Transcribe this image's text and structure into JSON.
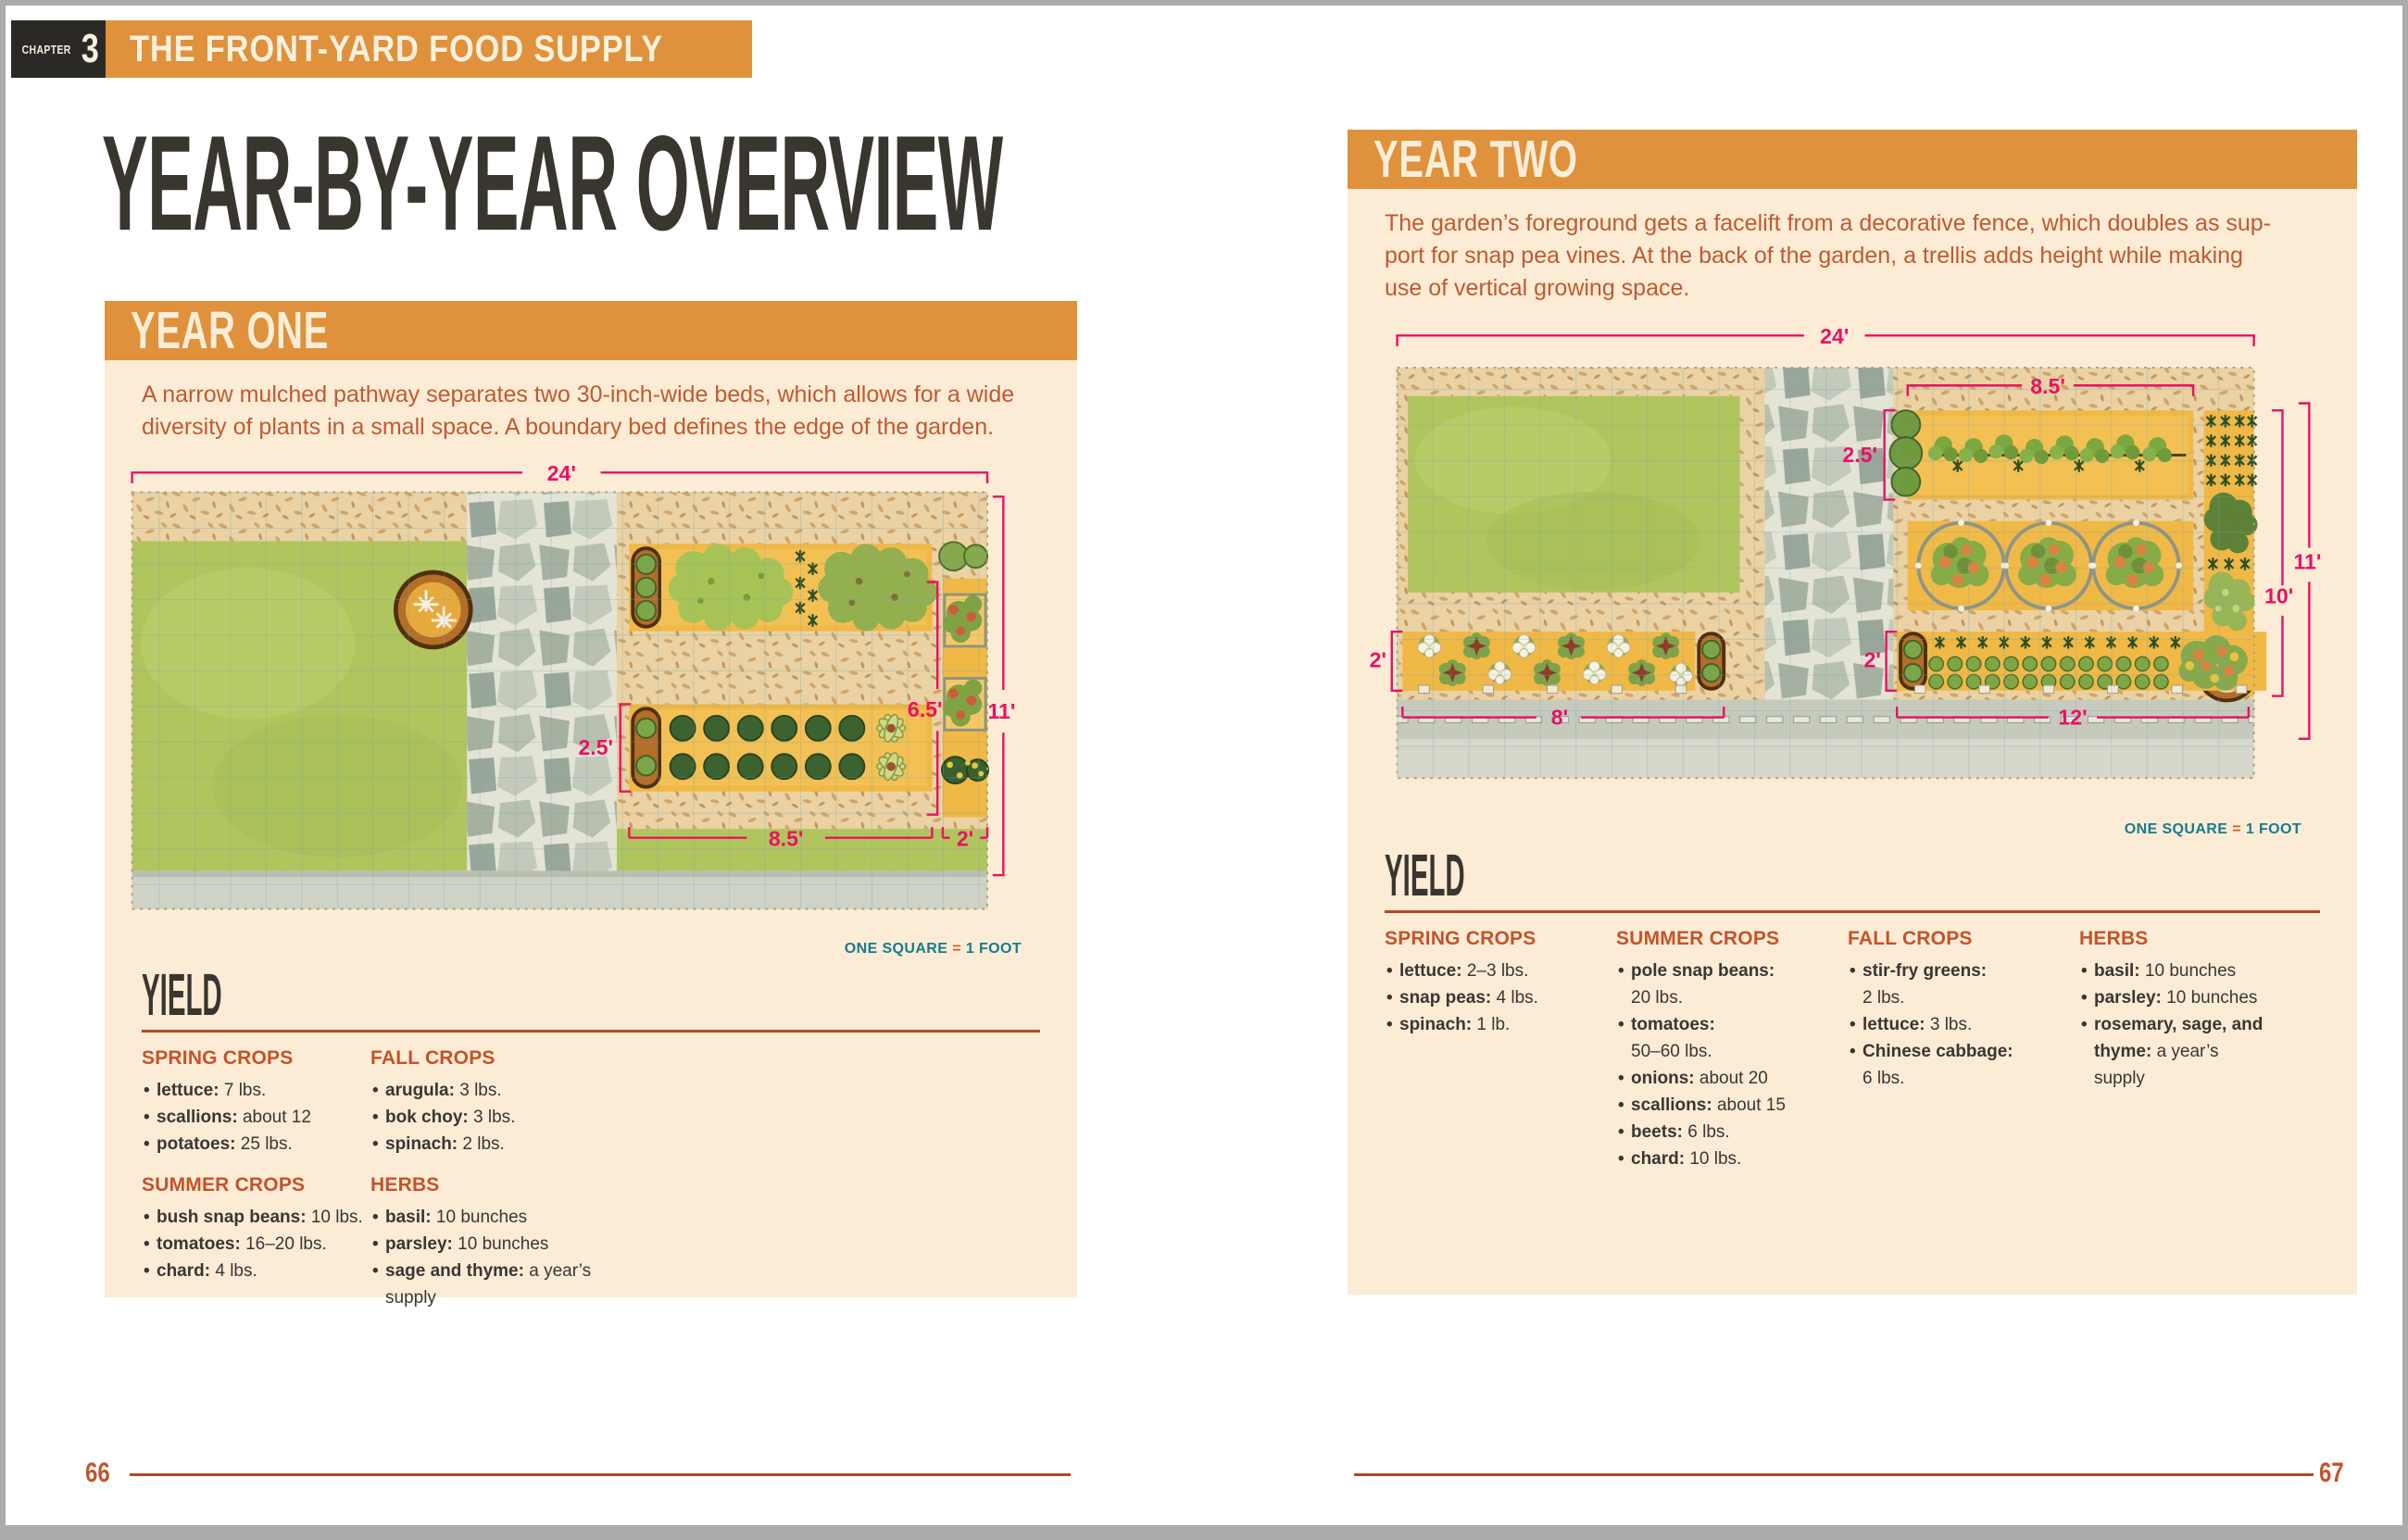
{
  "book": {
    "chapter": {
      "label": "CHAPTER",
      "number": "3",
      "title": "THE FRONT-YARD FOOD SUPPLY"
    },
    "title": "YEAR-BY-YEAR OVERVIEW",
    "scale": {
      "before": "ONE SQUARE",
      "eq": "=",
      "after": "1 FOOT"
    },
    "page_left": "66",
    "page_right": "67"
  },
  "colors": {
    "accent_orange": "#df913c",
    "panel_cream": "#fcecd6",
    "rust_text": "#c05a30",
    "heading_dark": "#39352f",
    "teal": "#157c8c",
    "dimension_pink": "#ea1164",
    "rule_rust": "#b14a23"
  },
  "year_one": {
    "header": "YEAR ONE",
    "intro": "A narrow mulched pathway separates two 30-inch-wide beds, which allows for a wide\ndiversity of plants in a small space. A boundary bed defines the edge of the garden.",
    "diagram": {
      "total_width": "24'",
      "bed_depth": "2.5'",
      "beds_span": "6.5'",
      "total_depth": "11'",
      "main_bed_length": "8.5'",
      "border_bed_width": "2'"
    },
    "yield": {
      "title": "YIELD",
      "spring": {
        "title": "SPRING CROPS",
        "items": [
          {
            "name": "lettuce:",
            "value": "7 lbs."
          },
          {
            "name": "scallions:",
            "value": "about 12"
          },
          {
            "name": "potatoes:",
            "value": "25 lbs."
          }
        ]
      },
      "summer": {
        "title": "SUMMER CROPS",
        "items": [
          {
            "name": "bush snap beans:",
            "value": "10 lbs."
          },
          {
            "name": "tomatoes:",
            "value": "16–20 lbs."
          },
          {
            "name": "chard:",
            "value": "4 lbs."
          }
        ]
      },
      "fall": {
        "title": "FALL CROPS",
        "items": [
          {
            "name": "arugula:",
            "value": "3 lbs."
          },
          {
            "name": "bok choy:",
            "value": "3 lbs."
          },
          {
            "name": "spinach:",
            "value": "2 lbs."
          }
        ]
      },
      "herbs": {
        "title": "HERBS",
        "items": [
          {
            "name": "basil:",
            "value": "10 bunches"
          },
          {
            "name": "parsley:",
            "value": "10 bunches"
          },
          {
            "name": "sage and thyme:",
            "value": "a year’s supply"
          }
        ]
      }
    }
  },
  "year_two": {
    "header": "YEAR TWO",
    "intro": "The garden’s foreground gets a facelift from a decorative fence, which doubles as sup-\nport for snap pea vines. At the back of the garden, a trellis adds height while making\nuse of vertical growing space.",
    "diagram": {
      "total_width": "24'",
      "trellis_bed_length": "8.5'",
      "trellis_bed_depth": "2.5'",
      "total_depth": "11'",
      "right_span": "10'",
      "front_bed_depth_left": "2'",
      "front_bed_depth_right": "2'",
      "front_bed_length_left": "8'",
      "front_bed_length_right": "12'"
    },
    "yield": {
      "title": "YIELD",
      "spring": {
        "title": "SPRING CROPS",
        "items": [
          {
            "name": "lettuce:",
            "value": "2–3 lbs."
          },
          {
            "name": "snap peas:",
            "value": "4 lbs."
          },
          {
            "name": "spinach:",
            "value": "1 lb."
          }
        ]
      },
      "summer": {
        "title": "SUMMER CROPS",
        "items": [
          {
            "name": "pole snap beans:",
            "value": "\n20 lbs."
          },
          {
            "name": "tomatoes:",
            "value": "\n50–60 lbs."
          },
          {
            "name": "onions:",
            "value": "about 20"
          },
          {
            "name": "scallions:",
            "value": "about 15"
          },
          {
            "name": "beets:",
            "value": "6 lbs."
          },
          {
            "name": "chard:",
            "value": "10 lbs."
          }
        ]
      },
      "fall": {
        "title": "FALL CROPS",
        "items": [
          {
            "name": "stir-fry greens:",
            "value": "\n2 lbs."
          },
          {
            "name": "lettuce:",
            "value": "3 lbs."
          },
          {
            "name": "Chinese cabbage:",
            "value": "\n6 lbs."
          }
        ]
      },
      "herbs": {
        "title": "HERBS",
        "items": [
          {
            "name": "basil:",
            "value": "10 bunches"
          },
          {
            "name": "parsley:",
            "value": "10 bunches"
          },
          {
            "name": "rosemary, sage, and thyme:",
            "value": "a year’s supply"
          }
        ]
      }
    }
  }
}
